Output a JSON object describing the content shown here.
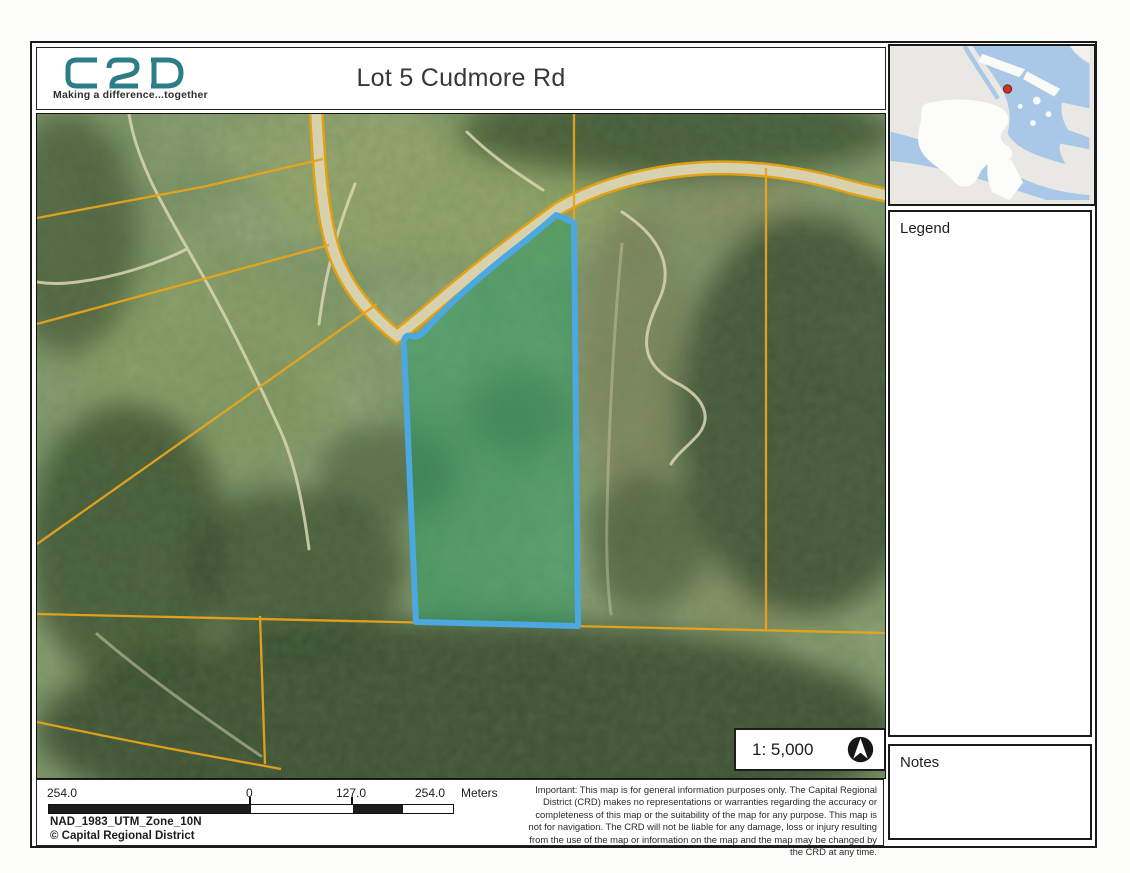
{
  "header": {
    "logo": "CRD",
    "tagline": "Making a difference...together",
    "title": "Lot 5 Cudmore Rd"
  },
  "map": {
    "scale_text": "1: 5,000",
    "parcel_outline_color": "#4ba8e0",
    "parcel_fill_color": "rgba(40,155,100,0.5)",
    "cadastral_line_color": "#e7a41c",
    "road_color": "#d8d1ae"
  },
  "inset": {
    "marker_color": "#c03a2b",
    "water_color": "#a9c7e7",
    "land_color": "#e9e8e4"
  },
  "legend": {
    "title": "Legend"
  },
  "notes": {
    "title": "Notes"
  },
  "scalebar": {
    "left_label": "254.0",
    "zero_label": "0",
    "mid_label": "127.0",
    "right_label": "254.0",
    "units": "Meters",
    "datum": "NAD_1983_UTM_Zone_10N",
    "copyright": "© Capital Regional District"
  },
  "disclaimer": {
    "text": "Important: This map is for general information purposes only. The Capital Regional District (CRD) makes no representations or warranties regarding the accuracy or completeness of this map or the suitability of the map for any purpose. This map is not for navigation. The CRD will not be liable for any damage, loss or injury resulting from the use of the map or information on the map and the map may be changed by the CRD at any time."
  }
}
